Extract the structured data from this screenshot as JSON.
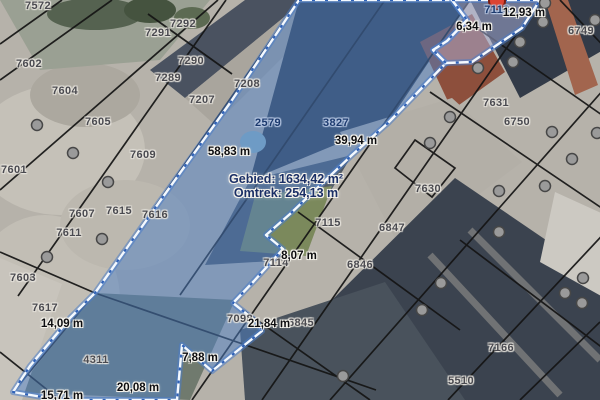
{
  "map": {
    "measurement_readout": {
      "area_label": "Gebied:",
      "area_value": "1634,42 m²",
      "perimeter_label": "Omtrek:",
      "perimeter_value": "254,13 m"
    },
    "parcel_labels": [
      {
        "id": "7572",
        "x": 38,
        "y": 6
      },
      {
        "id": "7292",
        "x": 183,
        "y": 24
      },
      {
        "id": "7291",
        "x": 158,
        "y": 33
      },
      {
        "id": "7290",
        "x": 191,
        "y": 61
      },
      {
        "id": "7289",
        "x": 168,
        "y": 78
      },
      {
        "id": "7602",
        "x": 29,
        "y": 64
      },
      {
        "id": "7604",
        "x": 65,
        "y": 91
      },
      {
        "id": "7605",
        "x": 98,
        "y": 122
      },
      {
        "id": "7609",
        "x": 143,
        "y": 155
      },
      {
        "id": "7601",
        "x": 14,
        "y": 170
      },
      {
        "id": "7207",
        "x": 202,
        "y": 100
      },
      {
        "id": "7208",
        "x": 247,
        "y": 84
      },
      {
        "id": "7607",
        "x": 82,
        "y": 214
      },
      {
        "id": "7615",
        "x": 119,
        "y": 211
      },
      {
        "id": "7616",
        "x": 155,
        "y": 215
      },
      {
        "id": "7611",
        "x": 69,
        "y": 233
      },
      {
        "id": "7603",
        "x": 23,
        "y": 278
      },
      {
        "id": "7617",
        "x": 45,
        "y": 308
      },
      {
        "id": "2579",
        "x": 268,
        "y": 123,
        "on_selection": true
      },
      {
        "id": "3827",
        "x": 336,
        "y": 123,
        "on_selection": true
      },
      {
        "id": "7113",
        "x": 497,
        "y": 10,
        "on_selection": true
      },
      {
        "id": "6749",
        "x": 581,
        "y": 31
      },
      {
        "id": "7631",
        "x": 496,
        "y": 103
      },
      {
        "id": "6750",
        "x": 517,
        "y": 122
      },
      {
        "id": "7630",
        "x": 428,
        "y": 189
      },
      {
        "id": "7115",
        "x": 328,
        "y": 223
      },
      {
        "id": "6847",
        "x": 392,
        "y": 228
      },
      {
        "id": "7114",
        "x": 276,
        "y": 263
      },
      {
        "id": "6846",
        "x": 360,
        "y": 265
      },
      {
        "id": "7098",
        "x": 240,
        "y": 319
      },
      {
        "id": "6845",
        "x": 301,
        "y": 323
      },
      {
        "id": "4311",
        "x": 96,
        "y": 360
      },
      {
        "id": "7166",
        "x": 501,
        "y": 348
      },
      {
        "id": "5510",
        "x": 461,
        "y": 381
      }
    ],
    "segment_labels": [
      {
        "text": "12,93 m",
        "x": 524,
        "y": 13
      },
      {
        "text": "6,34 m",
        "x": 474,
        "y": 27
      },
      {
        "text": "58,83 m",
        "x": 229,
        "y": 152
      },
      {
        "text": "39,94 m",
        "x": 356,
        "y": 141
      },
      {
        "text": "8,07 m",
        "x": 299,
        "y": 256
      },
      {
        "text": "21,84 m",
        "x": 269,
        "y": 324
      },
      {
        "text": "14,09 m",
        "x": 62,
        "y": 324
      },
      {
        "text": "7,88 m",
        "x": 200,
        "y": 358
      },
      {
        "text": "20,08 m",
        "x": 138,
        "y": 388
      },
      {
        "text": "15,71 m",
        "x": 62,
        "y": 396
      }
    ],
    "markers": {
      "red_point": {
        "x": 497,
        "y": 1
      },
      "gray_points": [
        [
          37,
          125
        ],
        [
          73,
          153
        ],
        [
          108,
          182
        ],
        [
          102,
          239
        ],
        [
          47,
          257
        ],
        [
          343,
          376
        ],
        [
          545,
          3
        ],
        [
          543,
          22
        ],
        [
          520,
          42
        ],
        [
          513,
          62
        ],
        [
          478,
          68
        ],
        [
          595,
          20
        ],
        [
          450,
          117
        ],
        [
          430,
          143
        ],
        [
          552,
          132
        ],
        [
          597,
          133
        ],
        [
          572,
          159
        ],
        [
          499,
          191
        ],
        [
          545,
          186
        ],
        [
          499,
          232
        ],
        [
          441,
          283
        ],
        [
          583,
          278
        ],
        [
          565,
          293
        ],
        [
          422,
          310
        ],
        [
          582,
          303
        ]
      ]
    },
    "colors": {
      "selection_fill": "rgba(77,127,198,0.5)",
      "selection_fill_light": "rgba(172,180,224,0.5)",
      "selection_casing": "#4a7cc6",
      "selection_edge_white": "#f4f9ff",
      "selection_edge_blue": "#2f62b8",
      "boundary_line": "#141414",
      "parcel_label": "#4a4a50",
      "selected_parcel_label": "#1c3a6e",
      "measure_label": "#0d0d10",
      "readout_text": "#1a2f66",
      "halo": "#e9e6df",
      "halo_strong": "#f5f3ec",
      "red_marker_fill": "#dd4433",
      "red_marker_stroke": "#7d1d11",
      "gray_marker_fill": "#9a9a9a",
      "gray_marker_stroke": "#474747"
    }
  }
}
